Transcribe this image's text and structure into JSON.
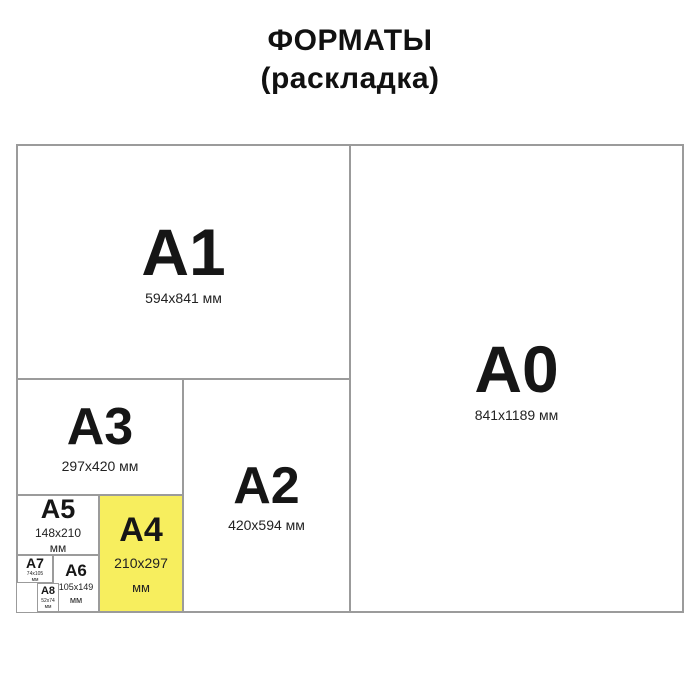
{
  "title": {
    "line1": "ФОРМАТЫ",
    "line2": "(раскладка)"
  },
  "colors": {
    "highlight_yellow": "#f7ee5e",
    "line_gray": "#9b9b9b",
    "text_black": "#161616"
  },
  "formats": {
    "a0": {
      "label": "A0",
      "dims": "841x1189 мм"
    },
    "a1": {
      "label": "A1",
      "dims": "594x841 мм"
    },
    "a2": {
      "label": "A2",
      "dims": "420x594 мм"
    },
    "a3": {
      "label": "A3",
      "dims": "297x420 мм"
    },
    "a4": {
      "label": "A4",
      "dims_line1": "210x297",
      "dims_line2": "мм",
      "highlighted": true
    },
    "a5": {
      "label": "A5",
      "dims_line1": "148x210",
      "dims_line2": "мм"
    },
    "a6": {
      "label": "A6",
      "dims_line1": "105x149",
      "dims_line2": "мм"
    },
    "a7": {
      "label": "A7",
      "dims_line1": "74x105",
      "dims_line2": "мм"
    },
    "a8": {
      "label": "A8",
      "dims_line1": "52x74",
      "dims_line2": "мм"
    }
  }
}
